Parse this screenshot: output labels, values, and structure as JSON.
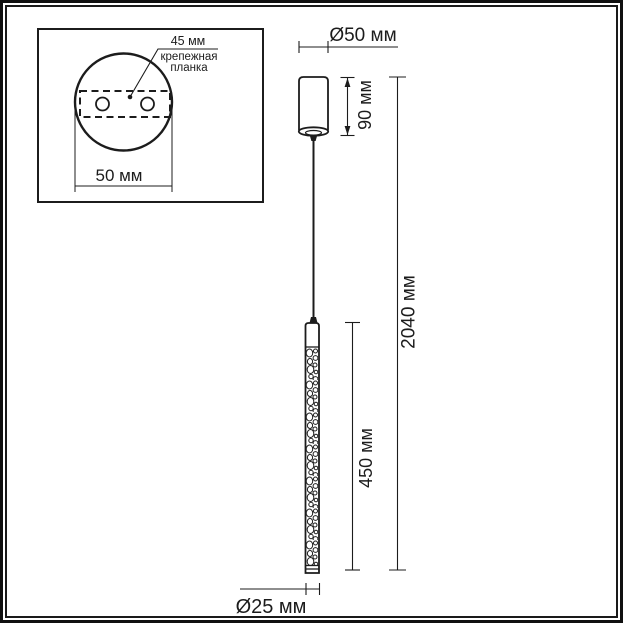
{
  "page": {
    "background_color": "#ffffff",
    "line_color": "#1c1c1c"
  },
  "inset": {
    "plate_width_label": "45 мм",
    "plate_name_line1": "крепежная",
    "plate_name_line2": "планка",
    "base_width_label": "50 мм"
  },
  "dimensions": {
    "canopy_diameter": "Ø50 мм",
    "canopy_height": "90 мм",
    "overall_height": "2040 мм",
    "shade_length": "450 мм",
    "shade_diameter": "Ø25 мм"
  }
}
